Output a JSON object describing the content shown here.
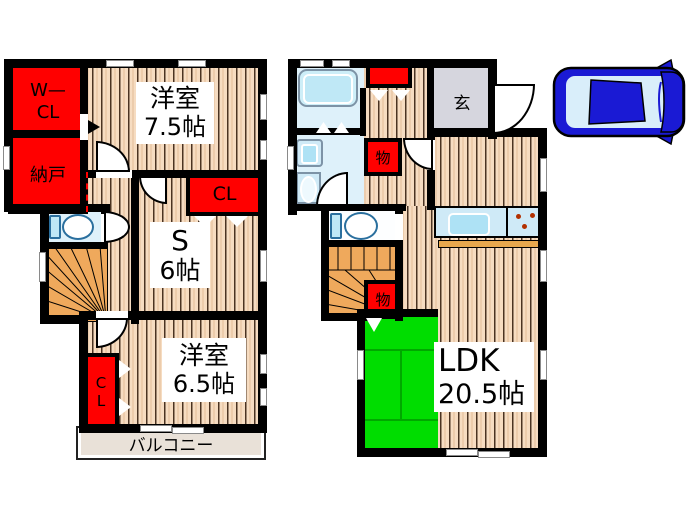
{
  "diagram_type": "japanese-house-floor-plan",
  "floor2": {
    "wcl_line1": "W—",
    "wcl_line2": "CL",
    "nando": "納戸",
    "room75_name": "洋室",
    "room75_size": "7.5帖",
    "cl_upper": "CL",
    "s_name": "S",
    "s_size": "6帖",
    "room65_name": "洋室",
    "room65_size": "6.5帖",
    "cl_lower_line1": "C",
    "cl_lower_line2": "L",
    "balcony": "バルコニー"
  },
  "floor1": {
    "genkan": "玄",
    "storage_top": "物",
    "storage_bottom": "物",
    "ldk_name": "LDK",
    "ldk_size": "20.5帖"
  },
  "colors": {
    "wall_black": "#000000",
    "closet_red": "#ff0000",
    "floor_tan": "#f6dcc1",
    "floor_stripe": "#4a3322",
    "tatami_green": "#00dd00",
    "tatami_line": "#00a800",
    "stair_orange": "#efa95c",
    "water_blue": "#def1fa",
    "fixture_blue": "#bfe8f6",
    "entrance_gray": "#d6d6de",
    "balcony_beige": "#e9e1d8",
    "car_blue": "#1a1ad4"
  },
  "icons": {
    "car": "car-top-view-icon",
    "toilet": "toilet-icon",
    "bathtub": "bathtub-icon",
    "sink": "kitchen-sink-icon",
    "stove": "stove-burners-icon",
    "stairs": "stairs-icon"
  }
}
